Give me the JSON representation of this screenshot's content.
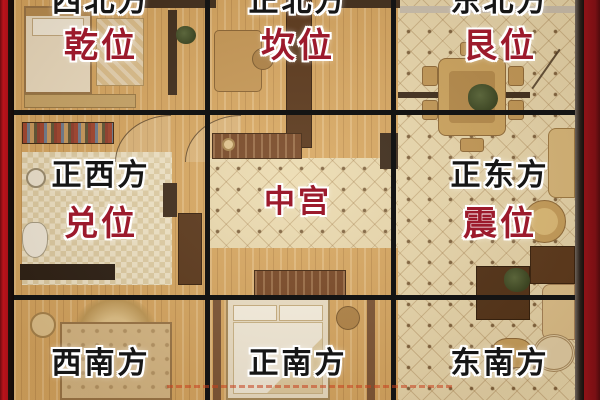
{
  "title": "住宅八卦九宫方位平面图",
  "cells": [
    {
      "key": "northwest",
      "direction": "西北方",
      "position": "乾位"
    },
    {
      "key": "north",
      "direction": "正北方",
      "position": "坎位"
    },
    {
      "key": "northeast",
      "direction": "东北方",
      "position": "艮位"
    },
    {
      "key": "west",
      "direction": "正西方",
      "position": "兑位"
    },
    {
      "key": "center",
      "direction": "",
      "position": "中宫"
    },
    {
      "key": "east",
      "direction": "正东方",
      "position": "震位"
    },
    {
      "key": "southwest",
      "direction": "西南方",
      "position": ""
    },
    {
      "key": "south",
      "direction": "正南方",
      "position": ""
    },
    {
      "key": "southeast",
      "direction": "东南方",
      "position": ""
    }
  ],
  "colors": {
    "frame_red": "#a91118",
    "grid_black": "#141414",
    "direction_text": "#161616",
    "position_text": "#9c1a2c",
    "wood_floor": "#d9a963",
    "tile_floor": "#ecdcb2"
  }
}
